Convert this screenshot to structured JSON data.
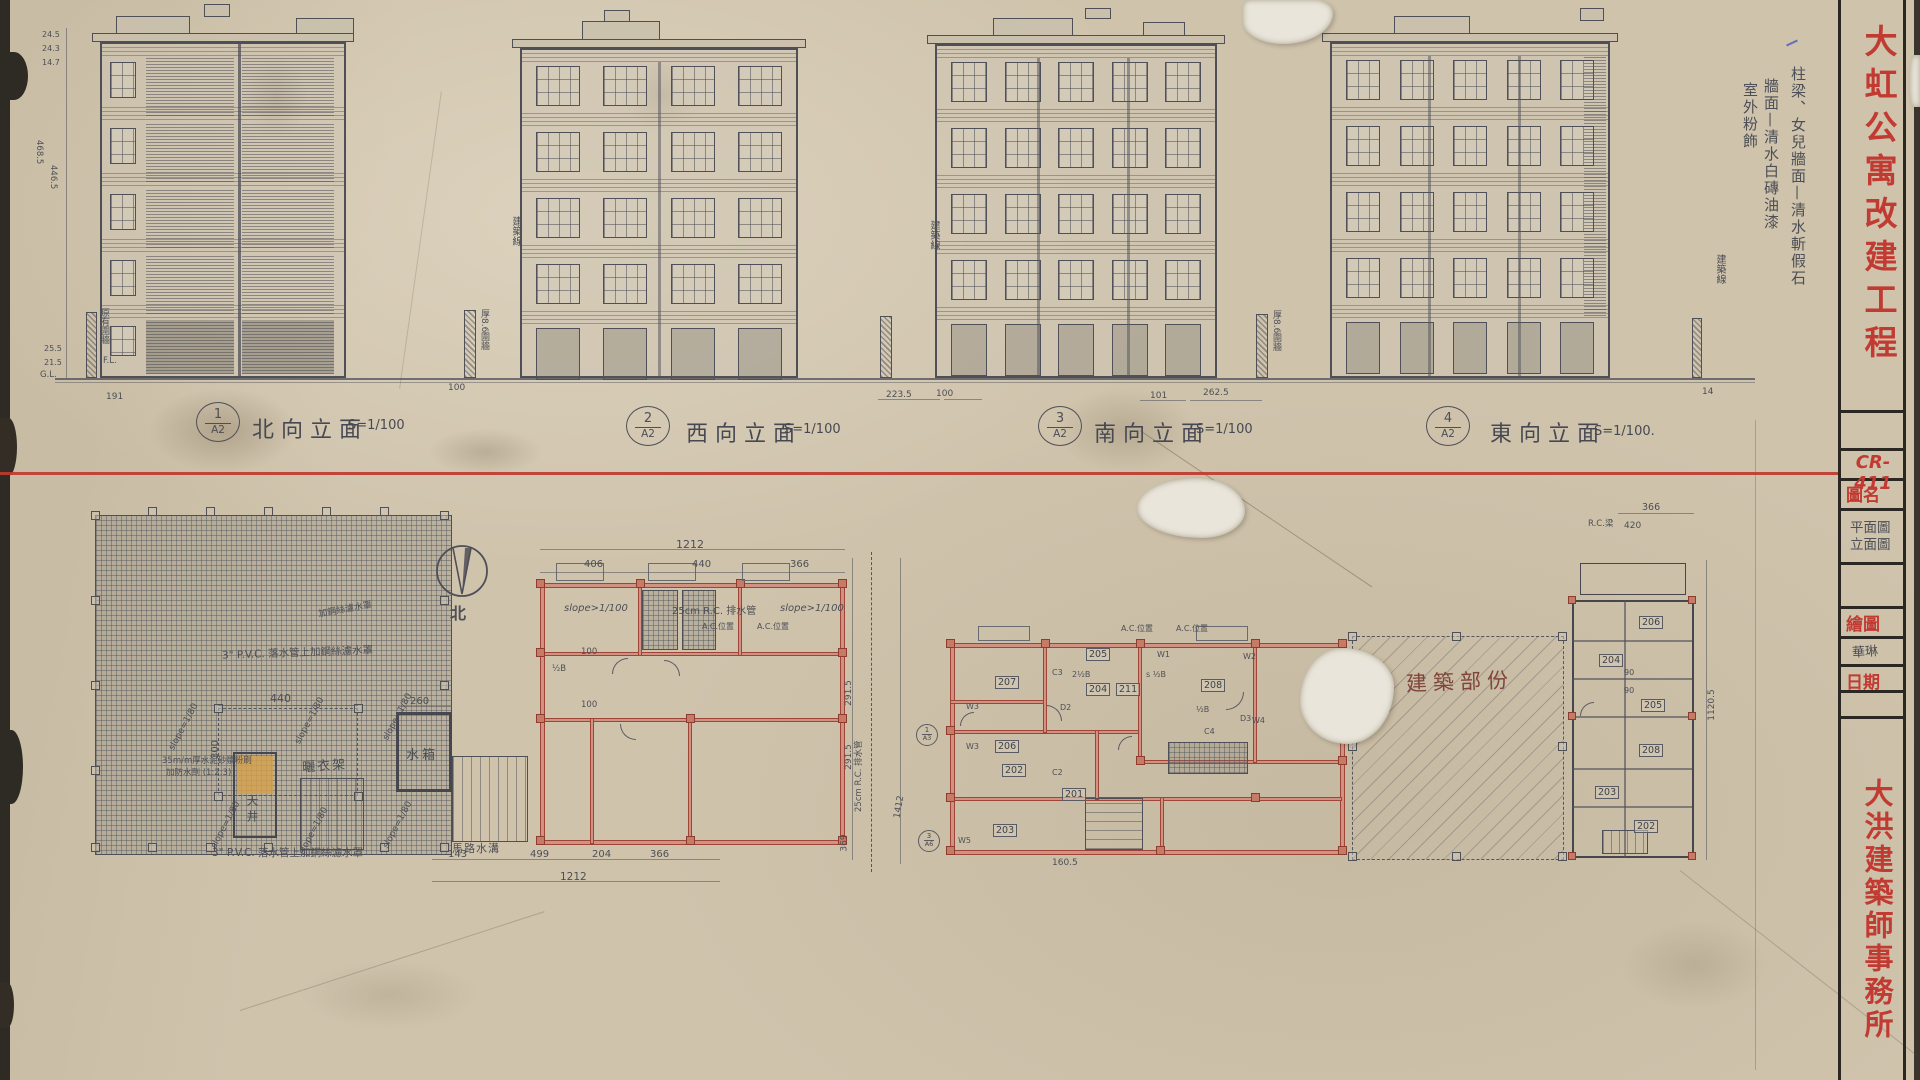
{
  "colors": {
    "paper": "#cfc3ac",
    "pencil": "#4d4f56",
    "red": "#c23b32",
    "wall_red": "#9e4538",
    "highlight": "#d6a04a"
  },
  "elevations": [
    {
      "num": "1",
      "sheet": "A2",
      "name": "北向立面",
      "scale": "S=1/100"
    },
    {
      "num": "2",
      "sheet": "A2",
      "name": "西向立面",
      "scale": "S=1/100"
    },
    {
      "num": "3",
      "sheet": "A2",
      "name": "南向立面",
      "scale": "S=1/100"
    },
    {
      "num": "4",
      "sheet": "A2",
      "name": "東向立面",
      "scale": "S=1/100."
    }
  ],
  "finish_notes": {
    "l1": "柱梁、女兒牆面—清水斬假石",
    "l2": "牆面—清水白磚油漆",
    "l3": "室外粉飾"
  },
  "site_notes": {
    "building_line": "建築線",
    "fence_left": "原有圍牆",
    "fence_thick": "厚8.6圍牆",
    "road_ditch": "馬路水溝"
  },
  "elev1_dims": {
    "v1": "24.5",
    "v2": "24.3",
    "v3": "14.7",
    "v4": "468.5",
    "v5": "446.5",
    "v6": "25.5",
    "v7": "21.5",
    "fl": "F.L.",
    "gl": "G.L.",
    "b1": "191",
    "b2": "100"
  },
  "ground_dims": {
    "d1": "223.5",
    "d2": "100",
    "d3": "101",
    "d4": "262.5",
    "d5": "14"
  },
  "roof_plan": {
    "pvc_note": "3\" P.V.C. 落水管上加鋼絲濾水罩",
    "pvc_note2": "3\" P.V.C. 落水管上加鋼絲濾水罩",
    "pvc_note3": "加鋼絲濾水罩",
    "slope": "slope=1/80",
    "dim_w": "440",
    "dim_h": "300",
    "dim_tank": "260",
    "tank": "水箱",
    "rack": "曬衣架",
    "well": "天井",
    "cement1": "35m/m厚水泥砂漿粉刷",
    "cement2": "加防水劑 (1:2:3)"
  },
  "compass": {
    "north": "北"
  },
  "plan_b": {
    "dim_total": "1212",
    "dim_a": "406",
    "dim_b": "440",
    "dim_c": "366",
    "slope": "slope>1/100",
    "rc_drain": "25cm R.C. 排水管",
    "slope2": "slope>1/100",
    "ac": "A.C.位置",
    "half": "½B",
    "d100a": "100",
    "d100b": "100",
    "bot_a": "143",
    "bot_b": "499",
    "bot_c": "204",
    "bot_d": "366",
    "bot_total": "1212"
  },
  "mid_dims": {
    "a": "291.5",
    "b": "291.5",
    "c": "369",
    "total": "1412",
    "drain": "25cm R.C. 排水管"
  },
  "plan_c": {
    "r207": "207",
    "r208": "208",
    "r206": "206",
    "r205": "205",
    "r204": "204",
    "r211": "211",
    "r203": "203",
    "r202": "202",
    "r201": "201",
    "w1": "W1",
    "w2": "W2",
    "w3": "W3",
    "w3b": "W3",
    "w4": "W4",
    "w5": "W5",
    "c2": "C2",
    "c3": "C3",
    "c4": "C4",
    "d2": "D2",
    "d3": "D3",
    "shalf": "s ½B",
    "half": "½B",
    "half2": "2½B",
    "ref1n": "1",
    "ref1s": "A3",
    "ref2n": "3",
    "ref2s": "A6",
    "ac1": "A.C.位置",
    "ac2": "A.C.位置",
    "dim": "160.5"
  },
  "hatch": {
    "label": "建築部份"
  },
  "plan_d": {
    "r206": "206",
    "r204": "204",
    "r205": "205",
    "r208": "208",
    "r203": "203",
    "r202": "202",
    "dim_top": "366",
    "dim_top2": "420",
    "d90a": "90",
    "d90b": "90",
    "dim_side": "1120.5",
    "note": "R.C.梁"
  },
  "title_block": {
    "project": "大虹公寓改建工程",
    "code": "CR-411",
    "field_name": "圖名",
    "name1": "平面圖",
    "name2": "立面圖",
    "field_draw": "繪圖",
    "drafter": "華琳",
    "field_date": "日期",
    "office": "大洪建築師事務所"
  }
}
